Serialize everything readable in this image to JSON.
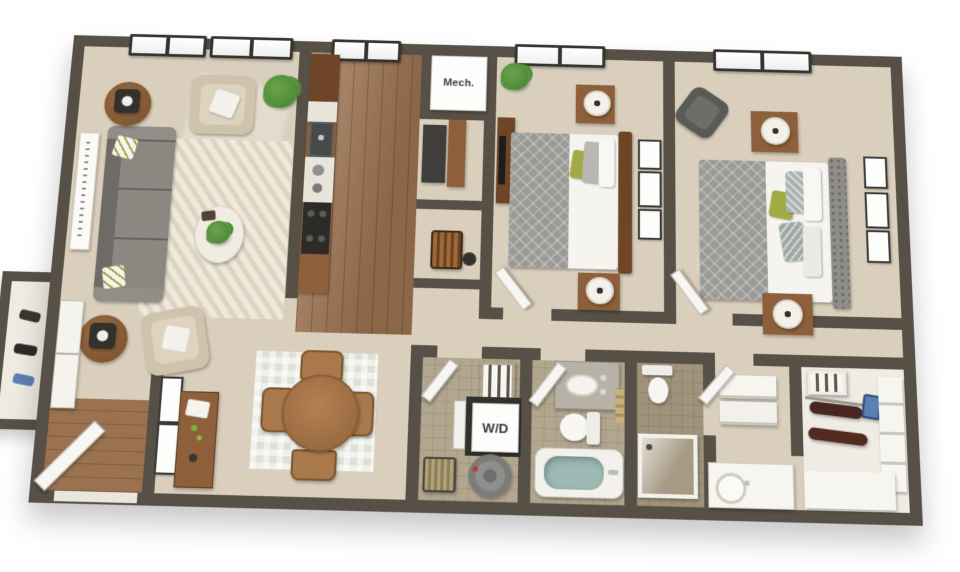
{
  "scene": {
    "type": "3d-floorplan-render",
    "labels": {
      "mech_room": "Mech.",
      "washer_dryer": "W/D"
    }
  },
  "colors": {
    "background": "#ffffff",
    "wall": "#575047",
    "carpet": "#d9cfbc",
    "carpet_light": "#e8e0cf",
    "wood_floor": "#9b7250",
    "tile": "#b2a68e",
    "tile_dark": "#a1937b",
    "white_fixture": "#f6f5f0",
    "sofa_gray": "#85827c",
    "sofa_gray_dark": "#6e6b66",
    "chair_beige": "#cfc3ad",
    "furniture_wood": "#8d5f3a",
    "furniture_wood_dark": "#6f4527",
    "bed_gray": "#9a9a96",
    "headboard_gray": "#8f8d89",
    "accent_green": "#a2aa45",
    "plant_green": "#4e8c38",
    "water_blue": "#9cb9b4",
    "glass_blue": "#ccd8d5",
    "rug_cream": "#efe9db",
    "dining_rug": "#dde1d5",
    "charcoal": "#33312d",
    "label_text": "#3d3d3d",
    "clothes_dark": "#46261f",
    "blue_accent": "#5c80b5",
    "window_frame": "#36342f"
  }
}
